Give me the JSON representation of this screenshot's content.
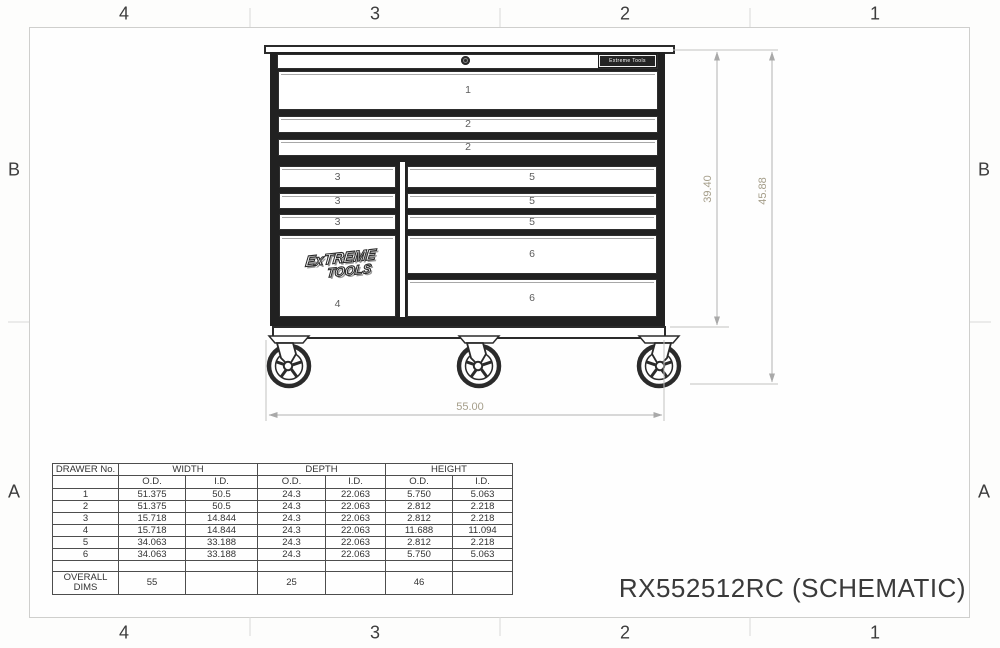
{
  "sheet": {
    "title": "RX552512RC (SCHEMATIC)",
    "zones_top": [
      "4",
      "3",
      "2",
      "1"
    ],
    "zones_bottom": [
      "4",
      "3",
      "2",
      "1"
    ],
    "zones_left": [
      "B",
      "A"
    ],
    "zones_right": [
      "B",
      "A"
    ]
  },
  "cabinet": {
    "badge": "Extreme Tools",
    "logo_line1": "ExTREME",
    "logo_line2": "TOOLS",
    "labels": {
      "d1": "1",
      "d2a": "2",
      "d2b": "2",
      "l3a": "3",
      "l3b": "3",
      "l3c": "3",
      "d4": "4",
      "r5a": "5",
      "r5b": "5",
      "r5c": "5",
      "r6a": "6",
      "r6b": "6"
    }
  },
  "dims": {
    "width": "55.00",
    "body_height": "39.40",
    "overall_height": "45.88"
  },
  "table": {
    "col_drawer": "DRAWER No.",
    "col_width": "WIDTH",
    "col_depth": "DEPTH",
    "col_height": "HEIGHT",
    "od": "O.D.",
    "id": "I.D.",
    "rows": [
      [
        "1",
        "51.375",
        "50.5",
        "24.3",
        "22.063",
        "5.750",
        "5.063"
      ],
      [
        "2",
        "51.375",
        "50.5",
        "24.3",
        "22.063",
        "2.812",
        "2.218"
      ],
      [
        "3",
        "15.718",
        "14.844",
        "24.3",
        "22.063",
        "2.812",
        "2.218"
      ],
      [
        "4",
        "15.718",
        "14.844",
        "24.3",
        "22.063",
        "11.688",
        "11.094"
      ],
      [
        "5",
        "34.063",
        "33.188",
        "24.3",
        "22.063",
        "2.812",
        "2.218"
      ],
      [
        "6",
        "34.063",
        "33.188",
        "24.3",
        "22.063",
        "5.750",
        "5.063"
      ]
    ],
    "overall_label": "OVERALL DIMS",
    "overall": [
      "55",
      "",
      "25",
      "",
      "46",
      ""
    ]
  },
  "colors": {
    "line_dark": "#2b2b2b",
    "dim_line": "#bdbdbd",
    "dim_text": "#a59e8a",
    "frame": "#cfcfcd"
  }
}
